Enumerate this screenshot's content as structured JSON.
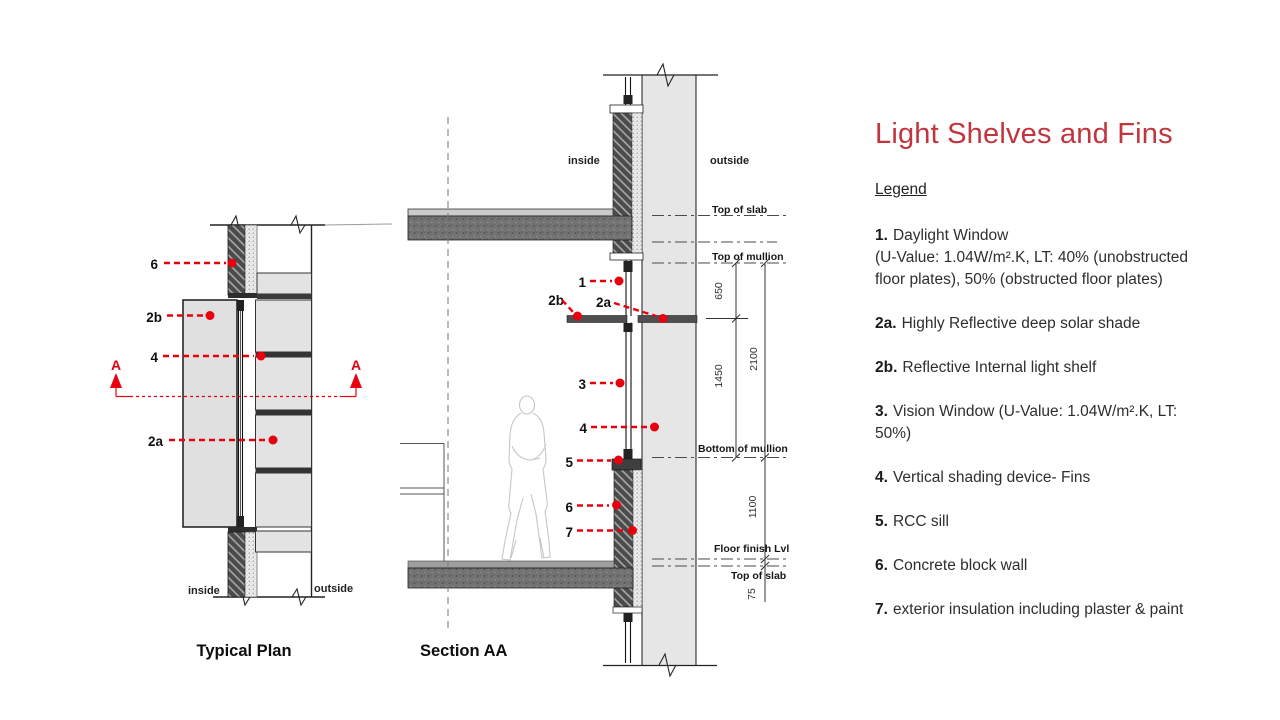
{
  "slide": {
    "title": "Light Shelves and Fins"
  },
  "plan": {
    "caption": "Typical Plan",
    "inside_label": "inside",
    "outside_label": "outside",
    "section_marker": "A",
    "callouts": {
      "c6": "6",
      "c2b": "2b",
      "c4": "4",
      "c2a": "2a"
    }
  },
  "section": {
    "caption": "Section AA",
    "inside_label": "inside",
    "outside_label": "outside",
    "callouts": {
      "c1": "1",
      "c2b": "2b",
      "c2a": "2a",
      "c3": "3",
      "c4": "4",
      "c5": "5",
      "c6": "6",
      "c7": "7"
    },
    "levels": {
      "top_of_slab_upper": "Top of slab",
      "top_of_mullion": "Top of mullion",
      "bottom_of_mullion": "Bottom of mullion",
      "floor_finish": "Floor finish Lvl",
      "top_of_slab_lower": "Top of slab"
    },
    "dimensions": {
      "d650": "650",
      "d1450": "1450",
      "d2100": "2100",
      "d1100": "1100",
      "d75": "75"
    }
  },
  "legend": {
    "heading": "Legend",
    "items": [
      {
        "num": "1.",
        "text": "Daylight Window\n(U-Value: 1.04W/m².K, LT: 40% (unobstructed\nfloor plates), 50% (obstructed floor plates)"
      },
      {
        "num": "2a.",
        "text": "Highly Reflective deep solar shade"
      },
      {
        "num": "2b.",
        "text": "Reflective Internal light shelf"
      },
      {
        "num": "3.",
        "text": "Vision Window (U-Value: 1.04W/m².K, LT:\n50%)"
      },
      {
        "num": "4.",
        "text": "Vertical shading device- Fins"
      },
      {
        "num": "5.",
        "text": "RCC sill"
      },
      {
        "num": "6.",
        "text": "Concrete block wall"
      },
      {
        "num": "7.",
        "text": "exterior insulation including plaster & paint"
      }
    ]
  },
  "colors": {
    "annotation_red": "#e8000f",
    "title_red": "#c1353f"
  }
}
